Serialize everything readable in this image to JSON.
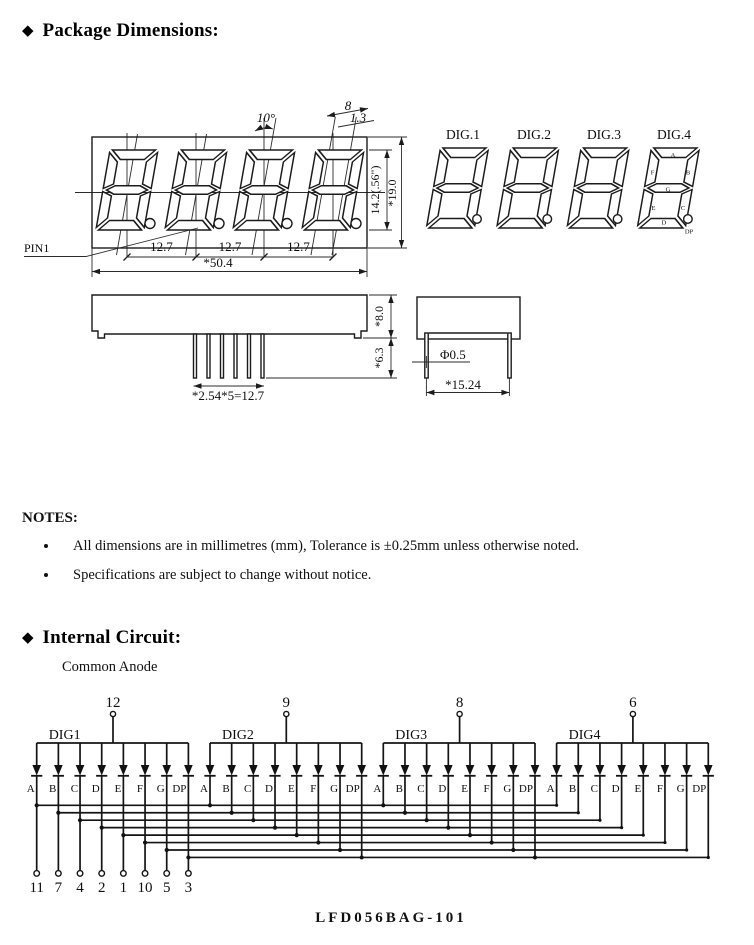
{
  "page": {
    "bullet_icon": "◆",
    "section1_title": "Package Dimensions:",
    "notes_title": "NOTES:",
    "notes": [
      "All dimensions are in millimetres (mm), Tolerance is ±0.25mm unless otherwise noted.",
      "Specifications are subject to change without notice."
    ],
    "section2_title": "Internal Circuit:",
    "part_number": "LFD056BAG-101"
  },
  "package": {
    "front": {
      "tilt_angle": "10°",
      "seg_width": "8",
      "seg_thickness": "1.3",
      "digit_height": "14.2(.56\")",
      "body_height": "*19.0",
      "digit_pitch": "12.7",
      "total_width": "*50.4",
      "pin1_label": "PIN1"
    },
    "digit_labels": [
      "DIG.1",
      "DIG.2",
      "DIG.3",
      "DIG.4"
    ],
    "side": {
      "body_thickness": "*8.0",
      "pin_length": "*6.3",
      "pin_pitch": "*2.54*5=12.7"
    },
    "end": {
      "pin_diameter": "Φ0.5",
      "pin_row_span": "*15.24"
    }
  },
  "circuit": {
    "subtitle": "Common Anode",
    "digits": [
      {
        "label": "DIG1",
        "top_pin": "12"
      },
      {
        "label": "DIG2",
        "top_pin": "9"
      },
      {
        "label": "DIG3",
        "top_pin": "8"
      },
      {
        "label": "DIG4",
        "top_pin": "6"
      }
    ],
    "segments": [
      "A",
      "B",
      "C",
      "D",
      "E",
      "F",
      "G",
      "DP"
    ],
    "bottom_pins": [
      "11",
      "7",
      "4",
      "2",
      "1",
      "10",
      "5",
      "3"
    ]
  }
}
